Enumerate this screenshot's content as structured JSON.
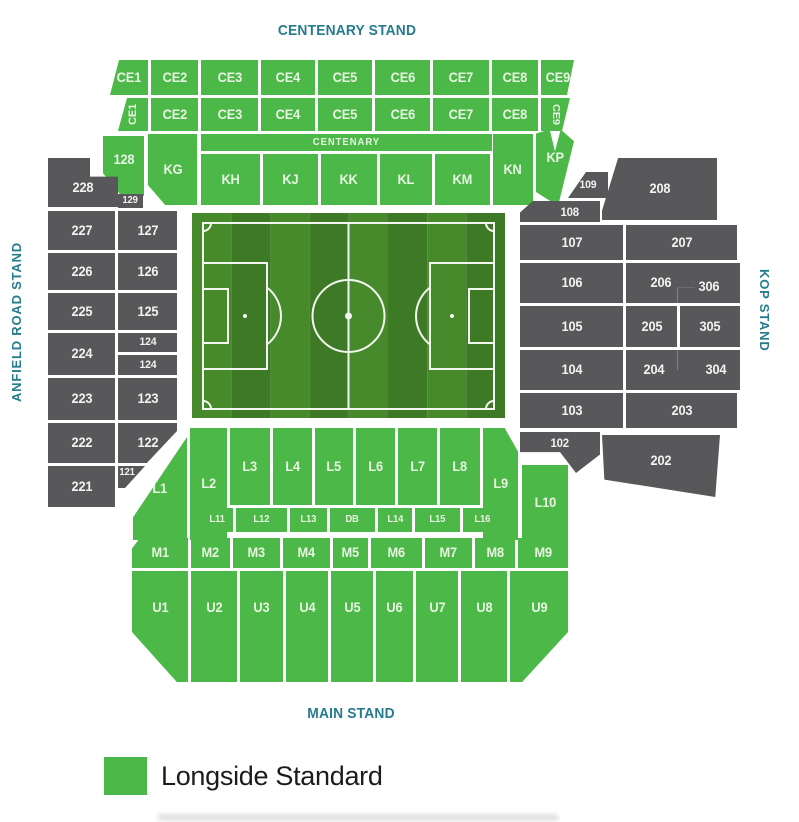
{
  "titles": {
    "centenary": "CENTENARY STAND",
    "main": "MAIN STAND",
    "anfield_road": "ANFIELD ROAD STAND",
    "kop": "KOP STAND"
  },
  "legend": {
    "items": [
      {
        "label": "Longside Standard",
        "color": "#4cb848"
      }
    ]
  },
  "colors": {
    "green": "#4cb848",
    "gray": "#58585a",
    "teal": "#257c8c"
  },
  "pitch": {
    "stripe_light": "#478a2b",
    "stripe_dark": "#3e7a25",
    "line": "#f4f7f1"
  },
  "sections": [
    {
      "l": "CE1",
      "k": "g",
      "x": 110,
      "y": 60,
      "w": 38,
      "h": 35,
      "c": "polygon(9px 0,100% 0,100% 100%,0 100%)"
    },
    {
      "l": "CE2",
      "k": "g",
      "x": 151,
      "y": 60,
      "w": 47,
      "h": 35
    },
    {
      "l": "CE3",
      "k": "g",
      "x": 201,
      "y": 60,
      "w": 57,
      "h": 35
    },
    {
      "l": "CE4",
      "k": "g",
      "x": 261,
      "y": 60,
      "w": 54,
      "h": 35
    },
    {
      "l": "CE5",
      "k": "g",
      "x": 318,
      "y": 60,
      "w": 54,
      "h": 35
    },
    {
      "l": "CE6",
      "k": "g",
      "x": 375,
      "y": 60,
      "w": 55,
      "h": 35
    },
    {
      "l": "CE7",
      "k": "g",
      "x": 433,
      "y": 60,
      "w": 56,
      "h": 35
    },
    {
      "l": "CE8",
      "k": "g",
      "x": 492,
      "y": 60,
      "w": 46,
      "h": 35
    },
    {
      "l": "CE9",
      "k": "g",
      "x": 541,
      "y": 60,
      "w": 33,
      "h": 35,
      "c": "polygon(0 0,100% 0,calc(100% - 7px) 100%,0 100%)"
    },
    {
      "l": "CE1",
      "k": "g",
      "x": 118,
      "y": 98,
      "w": 30,
      "h": 33,
      "v": "up",
      "f": 11,
      "c": "polygon(9px 0,100% 0,100% 100%,0 100%)"
    },
    {
      "l": "CE2",
      "k": "g",
      "x": 151,
      "y": 98,
      "w": 47,
      "h": 33
    },
    {
      "l": "CE3",
      "k": "g",
      "x": 201,
      "y": 98,
      "w": 57,
      "h": 33
    },
    {
      "l": "CE4",
      "k": "g",
      "x": 261,
      "y": 98,
      "w": 54,
      "h": 33
    },
    {
      "l": "CE5",
      "k": "g",
      "x": 318,
      "y": 98,
      "w": 54,
      "h": 33
    },
    {
      "l": "CE6",
      "k": "g",
      "x": 375,
      "y": 98,
      "w": 55,
      "h": 33
    },
    {
      "l": "CE7",
      "k": "g",
      "x": 433,
      "y": 98,
      "w": 56,
      "h": 33
    },
    {
      "l": "CE8",
      "k": "g",
      "x": 492,
      "y": 98,
      "w": 46,
      "h": 33
    },
    {
      "l": "CE9",
      "k": "g",
      "x": 541,
      "y": 98,
      "w": 29,
      "h": 33,
      "v": "down",
      "f": 11,
      "c": "polygon(0 0,100% 0,calc(100% - 8px) 100%,0 100%)"
    },
    {
      "l": "128",
      "k": "g",
      "x": 103,
      "y": 136,
      "w": 41,
      "h": 60,
      "pb": 12,
      "c": "polygon(0 0,100% 0,100% 100%,45% 100%,0 62%)"
    },
    {
      "l": "KG",
      "k": "g",
      "x": 148,
      "y": 134,
      "w": 49,
      "h": 71,
      "c": "polygon(0 0,100% 0,100% 100%,35% 100%,0 72%)"
    },
    {
      "l": "CENTENARY",
      "k": "g",
      "x": 201,
      "y": 134,
      "w": 291,
      "h": 17,
      "f": 10,
      "ls": 1
    },
    {
      "l": "KH",
      "k": "g",
      "x": 201,
      "y": 154,
      "w": 59,
      "h": 51
    },
    {
      "l": "KJ",
      "k": "g",
      "x": 263,
      "y": 154,
      "w": 55,
      "h": 51
    },
    {
      "l": "KK",
      "k": "g",
      "x": 321,
      "y": 154,
      "w": 56,
      "h": 51
    },
    {
      "l": "KL",
      "k": "g",
      "x": 380,
      "y": 154,
      "w": 52,
      "h": 51
    },
    {
      "l": "KM",
      "k": "g",
      "x": 435,
      "y": 154,
      "w": 55,
      "h": 51
    },
    {
      "l": "KN",
      "k": "g",
      "x": 493,
      "y": 134,
      "w": 40,
      "h": 71
    },
    {
      "l": "KP",
      "k": "g",
      "x": 536,
      "y": 128,
      "w": 38,
      "h": 78,
      "pb": 18,
      "c": "polygon(0 7%,36% 2%,50% 30%,65% 2%,100% 17%,58% 100%,0 82%)"
    },
    {
      "l": "228",
      "k": "d",
      "x": 48,
      "y": 158,
      "w": 70,
      "h": 49,
      "pt": 10,
      "c": "polygon(0 0,60% 0,60% 38%,100% 38%,100% 100%,0 100%)"
    },
    {
      "l": "129",
      "k": "d",
      "x": 118,
      "y": 194,
      "w": 25,
      "h": 14,
      "f": 10
    },
    {
      "l": "227",
      "k": "d",
      "x": 48,
      "y": 211,
      "w": 67,
      "h": 39
    },
    {
      "l": "127",
      "k": "d",
      "x": 118,
      "y": 211,
      "w": 59,
      "h": 39
    },
    {
      "l": "226",
      "k": "d",
      "x": 48,
      "y": 253,
      "w": 67,
      "h": 37
    },
    {
      "l": "126",
      "k": "d",
      "x": 118,
      "y": 253,
      "w": 59,
      "h": 37
    },
    {
      "l": "225",
      "k": "d",
      "x": 48,
      "y": 293,
      "w": 67,
      "h": 37
    },
    {
      "l": "125",
      "k": "d",
      "x": 118,
      "y": 293,
      "w": 59,
      "h": 37
    },
    {
      "l": "224",
      "k": "d",
      "x": 48,
      "y": 333,
      "w": 67,
      "h": 42
    },
    {
      "l": "124",
      "k": "d",
      "x": 118,
      "y": 333,
      "w": 59,
      "h": 19,
      "f": 11
    },
    {
      "l": "124",
      "k": "d",
      "x": 118,
      "y": 355,
      "w": 59,
      "h": 20,
      "f": 11
    },
    {
      "l": "223",
      "k": "d",
      "x": 48,
      "y": 378,
      "w": 67,
      "h": 42
    },
    {
      "l": "123",
      "k": "d",
      "x": 118,
      "y": 378,
      "w": 59,
      "h": 42
    },
    {
      "l": "222",
      "k": "d",
      "x": 48,
      "y": 423,
      "w": 67,
      "h": 40
    },
    {
      "l": "122",
      "k": "d",
      "x": 118,
      "y": 423,
      "w": 59,
      "h": 40,
      "c": "polygon(0 0,100% 0,100% 20%,49% 100%,0 100%)"
    },
    {
      "l": "221",
      "k": "d",
      "x": 48,
      "y": 466,
      "w": 67,
      "h": 41
    },
    {
      "l": "121",
      "k": "d",
      "x": 118,
      "y": 466,
      "w": 27,
      "h": 22,
      "f": 10,
      "pb": 8,
      "pr": 8,
      "c": "polygon(0 0,100% 0,26% 100%,0 100%)"
    },
    {
      "l": "109",
      "k": "d",
      "x": 568,
      "y": 172,
      "w": 40,
      "h": 26,
      "f": 11,
      "c": "polygon(45% 0,100% 0,100% 100%,0 100%)"
    },
    {
      "l": "208",
      "k": "d",
      "x": 602,
      "y": 158,
      "w": 115,
      "h": 62,
      "c": "polygon(14% 0,100% 0,100% 100%,0 100%,0 85%)"
    },
    {
      "l": "108",
      "k": "d",
      "x": 520,
      "y": 201,
      "w": 80,
      "h": 21,
      "f": 12,
      "pl": 20,
      "c": "polygon(16% 0,100% 0,100% 100%,0 100%,0 55%)"
    },
    {
      "l": "107",
      "k": "d",
      "x": 520,
      "y": 225,
      "w": 103,
      "h": 35
    },
    {
      "l": "207",
      "k": "d",
      "x": 626,
      "y": 225,
      "w": 111,
      "h": 35
    },
    {
      "l": "106",
      "k": "d",
      "x": 520,
      "y": 263,
      "w": 103,
      "h": 40
    },
    {
      "l": "206",
      "k": "d",
      "x": 626,
      "y": 263,
      "w": 69,
      "h": 40,
      "c": "polygon(0 0,100% 0,100% 62%,75% 62%,75% 100%,0 100%)"
    },
    {
      "l": "306",
      "k": "d",
      "x": 678,
      "y": 263,
      "w": 62,
      "h": 40,
      "pt": 8,
      "c": "polygon(27% 0,100% 0,100% 100%,0 100%,0 62%,27% 62%)"
    },
    {
      "l": "105",
      "k": "d",
      "x": 520,
      "y": 306,
      "w": 103,
      "h": 41
    },
    {
      "l": "205",
      "k": "d",
      "x": 626,
      "y": 306,
      "w": 51,
      "h": 41
    },
    {
      "l": "305",
      "k": "d",
      "x": 680,
      "y": 306,
      "w": 60,
      "h": 41
    },
    {
      "l": "104",
      "k": "d",
      "x": 520,
      "y": 350,
      "w": 103,
      "h": 40
    },
    {
      "l": "204",
      "k": "d",
      "x": 626,
      "y": 350,
      "w": 69,
      "h": 40,
      "pr": 14,
      "c": "polygon(0 0,75% 0,75% 50%,100% 50%,100% 100%,0 100%)"
    },
    {
      "l": "304",
      "k": "d",
      "x": 678,
      "y": 350,
      "w": 62,
      "h": 40,
      "pl": 14,
      "c": "polygon(0 0,100% 0,100% 100%,27% 100%,27% 50%,0 50%)"
    },
    {
      "l": "103",
      "k": "d",
      "x": 520,
      "y": 393,
      "w": 103,
      "h": 35
    },
    {
      "l": "203",
      "k": "d",
      "x": 626,
      "y": 393,
      "w": 111,
      "h": 35
    },
    {
      "l": "102",
      "k": "d",
      "x": 520,
      "y": 432,
      "w": 80,
      "h": 41,
      "f": 12,
      "pb": 20,
      "c": "polygon(0 0,100% 0,100% 55%,70% 100%,50% 49%,0 49%)"
    },
    {
      "l": "202",
      "k": "d",
      "x": 602,
      "y": 435,
      "w": 118,
      "h": 62,
      "pb": 10,
      "c": "polygon(0 0,100% 0,96% 100%,2% 72%)"
    },
    {
      "l": "L1",
      "k": "g",
      "x": 133,
      "y": 437,
      "w": 54,
      "h": 103,
      "c": "polygon(100% 0,100% 100%,0 100%,0 78%)"
    },
    {
      "l": "L2",
      "k": "g",
      "x": 190,
      "y": 428,
      "w": 37,
      "h": 112
    },
    {
      "l": "L3",
      "k": "g",
      "x": 230,
      "y": 428,
      "w": 40,
      "h": 77
    },
    {
      "l": "L4",
      "k": "g",
      "x": 273,
      "y": 428,
      "w": 39,
      "h": 77
    },
    {
      "l": "L5",
      "k": "g",
      "x": 315,
      "y": 428,
      "w": 38,
      "h": 77
    },
    {
      "l": "L6",
      "k": "g",
      "x": 356,
      "y": 428,
      "w": 39,
      "h": 77
    },
    {
      "l": "L7",
      "k": "g",
      "x": 398,
      "y": 428,
      "w": 39,
      "h": 77
    },
    {
      "l": "L8",
      "k": "g",
      "x": 440,
      "y": 428,
      "w": 40,
      "h": 77
    },
    {
      "l": "L9",
      "k": "g",
      "x": 483,
      "y": 428,
      "w": 35,
      "h": 112,
      "c": "polygon(0 0,62% 0,100% 21%,100% 100%,0 100%)"
    },
    {
      "l": "L10",
      "k": "g",
      "x": 522,
      "y": 465,
      "w": 46,
      "h": 75
    },
    {
      "l": "L11",
      "k": "g",
      "x": 202,
      "y": 508,
      "w": 31,
      "h": 24,
      "f": 10
    },
    {
      "l": "L12",
      "k": "g",
      "x": 236,
      "y": 508,
      "w": 51,
      "h": 24,
      "f": 10
    },
    {
      "l": "L13",
      "k": "g",
      "x": 290,
      "y": 508,
      "w": 37,
      "h": 24,
      "f": 10
    },
    {
      "l": "DB",
      "k": "g",
      "x": 330,
      "y": 508,
      "w": 45,
      "h": 24,
      "f": 10
    },
    {
      "l": "L14",
      "k": "g",
      "x": 378,
      "y": 508,
      "w": 34,
      "h": 24,
      "f": 10
    },
    {
      "l": "L15",
      "k": "g",
      "x": 415,
      "y": 508,
      "w": 45,
      "h": 24,
      "f": 10
    },
    {
      "l": "L16",
      "k": "g",
      "x": 463,
      "y": 508,
      "w": 39,
      "h": 24,
      "f": 10
    },
    {
      "l": "M1",
      "k": "g",
      "x": 132,
      "y": 538,
      "w": 56,
      "h": 30,
      "c": "polygon(0 35%,14% 0,100% 0,100% 100%,0 100%)"
    },
    {
      "l": "M2",
      "k": "g",
      "x": 191,
      "y": 538,
      "w": 39,
      "h": 30
    },
    {
      "l": "M3",
      "k": "g",
      "x": 233,
      "y": 538,
      "w": 47,
      "h": 30
    },
    {
      "l": "M4",
      "k": "g",
      "x": 283,
      "y": 538,
      "w": 47,
      "h": 30
    },
    {
      "l": "M5",
      "k": "g",
      "x": 333,
      "y": 538,
      "w": 35,
      "h": 30
    },
    {
      "l": "M6",
      "k": "g",
      "x": 371,
      "y": 538,
      "w": 51,
      "h": 30
    },
    {
      "l": "M7",
      "k": "g",
      "x": 425,
      "y": 538,
      "w": 47,
      "h": 30
    },
    {
      "l": "M8",
      "k": "g",
      "x": 475,
      "y": 538,
      "w": 40,
      "h": 30
    },
    {
      "l": "M9",
      "k": "g",
      "x": 518,
      "y": 538,
      "w": 50,
      "h": 30
    },
    {
      "l": "U1",
      "k": "g",
      "x": 132,
      "y": 571,
      "w": 56,
      "h": 111,
      "pb": 38,
      "c": "polygon(0 0,100% 0,100% 100%,80% 100%,0 55%)"
    },
    {
      "l": "U2",
      "k": "g",
      "x": 191,
      "y": 571,
      "w": 46,
      "h": 111,
      "pb": 38
    },
    {
      "l": "U3",
      "k": "g",
      "x": 240,
      "y": 571,
      "w": 43,
      "h": 111,
      "pb": 38
    },
    {
      "l": "U4",
      "k": "g",
      "x": 286,
      "y": 571,
      "w": 42,
      "h": 111,
      "pb": 38
    },
    {
      "l": "U5",
      "k": "g",
      "x": 331,
      "y": 571,
      "w": 42,
      "h": 111,
      "pb": 38
    },
    {
      "l": "U6",
      "k": "g",
      "x": 376,
      "y": 571,
      "w": 37,
      "h": 111,
      "pb": 38
    },
    {
      "l": "U7",
      "k": "g",
      "x": 416,
      "y": 571,
      "w": 42,
      "h": 111,
      "pb": 38
    },
    {
      "l": "U8",
      "k": "g",
      "x": 461,
      "y": 571,
      "w": 46,
      "h": 111,
      "pb": 38
    },
    {
      "l": "U9",
      "k": "g",
      "x": 510,
      "y": 571,
      "w": 58,
      "h": 111,
      "pb": 38,
      "c": "polygon(0 0,100% 0,100% 55%,21% 100%,0 100%)"
    }
  ]
}
